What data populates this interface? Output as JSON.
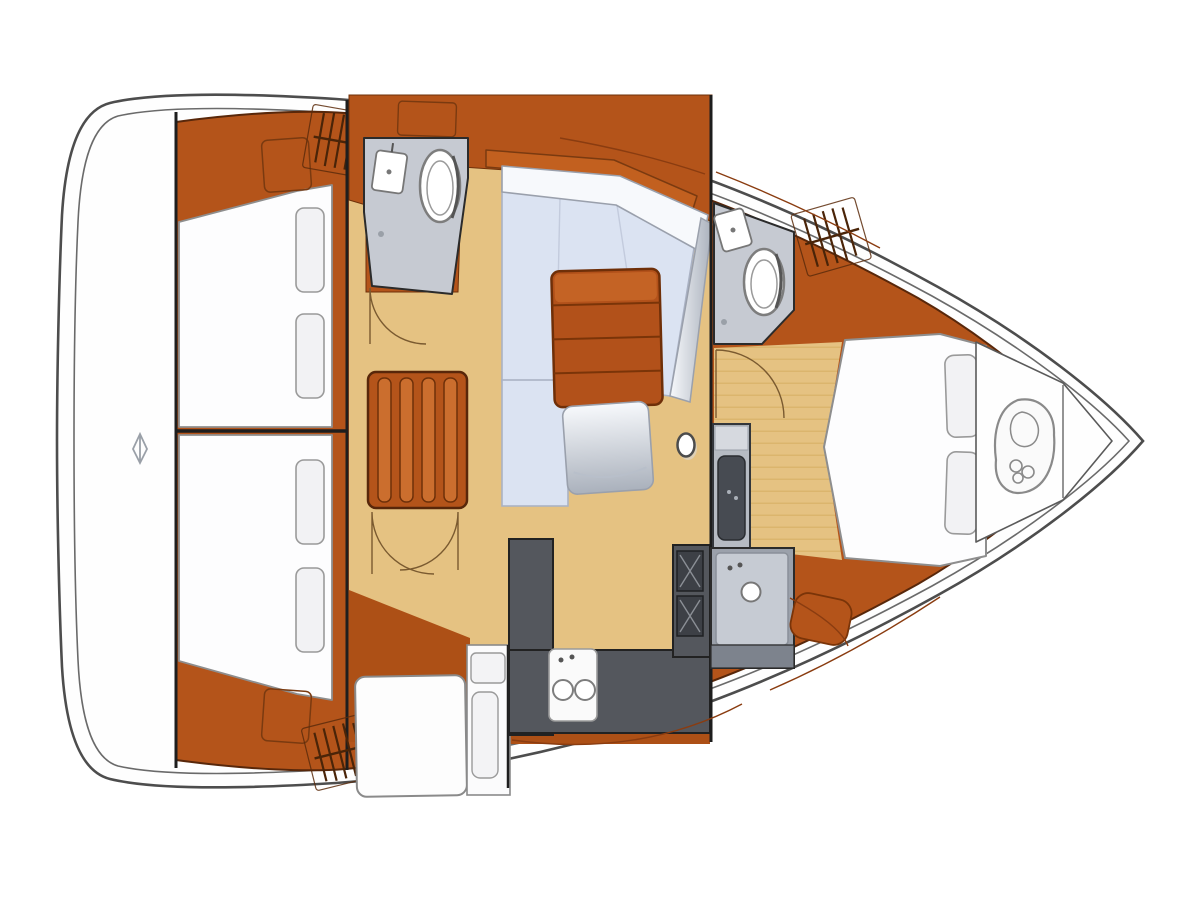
{
  "document": {
    "type": "yacht-interior-floor-plan",
    "orientation": {
      "bow": "right",
      "stern": "left"
    },
    "visible_text": []
  },
  "palette": {
    "page_bg": "#ffffff",
    "hull_outline": "#4d4d4d",
    "hull_inner_line": "#6a6a6a",
    "deck_white": "#fefefe",
    "joinery_orange": "#b4541a",
    "joinery_orange_dark": "#a04810",
    "joinery_line": "#6e3009",
    "floor_tan": "#e5c282",
    "floor_plank_line": "#d9b268",
    "settee_blue": "#dbe3f2",
    "settee_edge": "#aab2c4",
    "silver_high": "#f7f9fc",
    "silver_low": "#aab1bc",
    "table_wood": "#b2511a",
    "table_wood_light": "#c76628",
    "counter_gray": "#54575d",
    "appliance_dark": "#3d4046",
    "head_floor_gray": "#c6cad2",
    "shower_gray": "#b6bbc3",
    "vanity_gray": "#9ba1ab",
    "fixture_white": "#ffffff",
    "fixture_ring": "#7d7d7d",
    "bed_white": "#fdfdfe",
    "pillow_white": "#f2f2f4",
    "bulkhead_dark": "#1e1e1e",
    "arc_line": "#7a5a30",
    "symbol_gray": "#8a8a8a"
  },
  "regions": {
    "stern_deck": {
      "name": "stern deck",
      "symbols": [
        "stern-anchor-icon"
      ]
    },
    "aft_cabin_upper": {
      "name": "aft cabin (port quarter)",
      "features": [
        "double berth",
        "2 pillows",
        "locker",
        "deck-hatch-icon"
      ]
    },
    "aft_cabin_lower": {
      "name": "aft cabin (starboard quarter)",
      "features": [
        "double berth",
        "2 pillows",
        "locker",
        "deck-hatch-icon"
      ]
    },
    "aft_head": {
      "name": "aft head",
      "fixtures": [
        "washbasin",
        "toilet"
      ]
    },
    "salon": {
      "name": "salon",
      "features": [
        "companionway stairs",
        "L-settee",
        "cocktail table",
        "ottoman",
        "mast post",
        "chart table",
        "chart seat",
        "sideboard"
      ]
    },
    "galley": {
      "name": "galley",
      "fixtures": [
        "U-counter",
        "double sink",
        "two-burner stove"
      ]
    },
    "forward_head": {
      "name": "forward head",
      "fixtures": [
        "washbasin",
        "toilet",
        "shower",
        "vanity sink"
      ]
    },
    "forward_cabin": {
      "name": "forward cabin",
      "features": [
        "island berth",
        "2 pillows",
        "foot bench",
        "deck-hatch-icon"
      ]
    },
    "foredeck": {
      "name": "foredeck",
      "symbols": [
        "anchor-chain-locker-icon"
      ]
    }
  }
}
